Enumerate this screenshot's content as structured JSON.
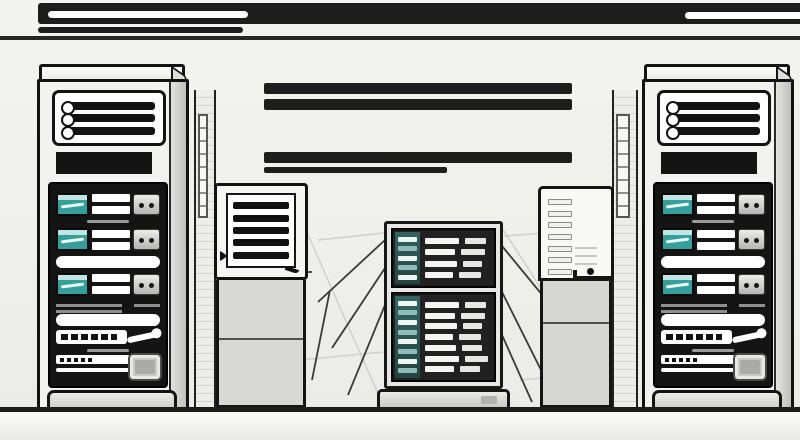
{
  "scene": {
    "description": "Black-and-white stylized illustration of a data center: two large server towers at left and right, a central server rack with teal indicator columns, two auxiliary cabinets, scaffold columns, decorative black bars at top and middle, cables and a floor line",
    "colors": {
      "background": "#efefec",
      "ink": "#1c1c1c",
      "panel_dark": "#141414",
      "metal_light": "#f2f2f0",
      "metal_mid": "#d8d8d6",
      "metal_shadow": "#c0c0be",
      "teal_lcd": "#35a09b",
      "teal_dark": "#2c5a55",
      "teal_pale": "#bfe6e3",
      "floor": "#f6f6f4",
      "floor_line": "#1b1b1b",
      "white": "#ffffff"
    },
    "banner": {
      "white_stripes": 2,
      "sub_bar": 1
    },
    "mid_bars": 4,
    "left_tower": {
      "vent_slats": 3,
      "drive_trays": 3
    },
    "right_tower": {
      "vent_slats": 3,
      "drive_trays": 3
    },
    "left_cabinet": {
      "vent_slats": 5
    },
    "right_cabinet": {
      "vent_slats": 7
    },
    "center_rack": {
      "top_rows": 4,
      "bottom_rows": 7,
      "teal_cells_top": 5,
      "teal_cells_bottom": 8
    }
  }
}
